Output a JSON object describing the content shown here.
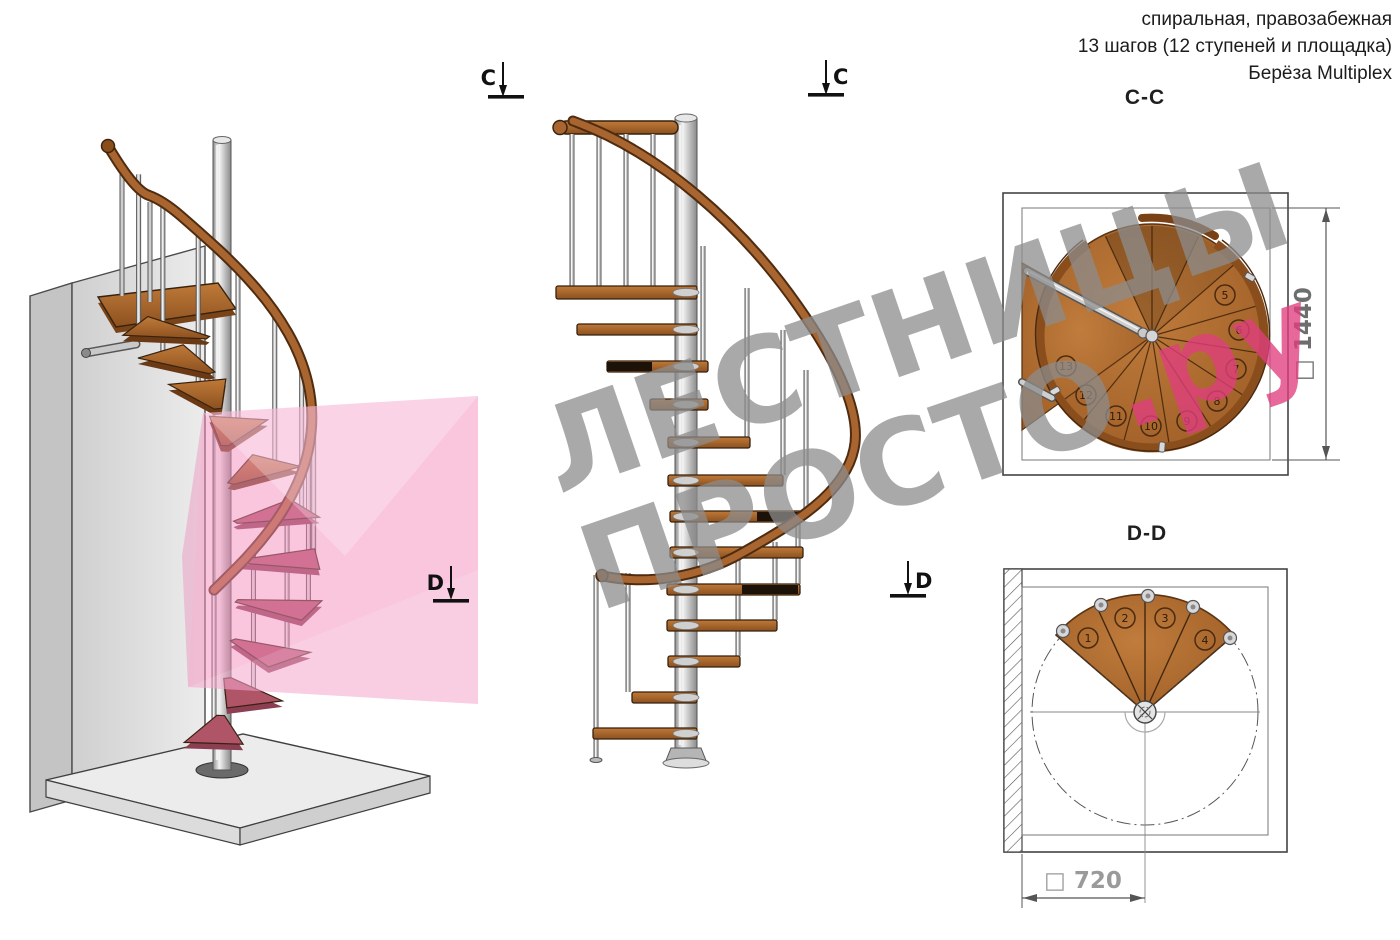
{
  "header": {
    "line1": "спиральная, правозабежная",
    "line2": "13 шагов (12 ступеней и площадка)",
    "line3": "Берёза Multiplex"
  },
  "watermark": {
    "line1": "ЛЕСТНИЦЫ",
    "line2_gray": "ПРОСТО",
    "line2_pink": ".ру"
  },
  "section_markers": {
    "c_left": "C",
    "c_right": "C",
    "d_left": "D",
    "d_right": "D"
  },
  "cc_plan": {
    "title": "C-C",
    "dimension_label": "□ 1440",
    "step_numbers": [
      "5",
      "6",
      "7",
      "8",
      "9",
      "10",
      "11",
      "12",
      "13"
    ]
  },
  "dd_plan": {
    "title": "D-D",
    "dimension_label": "□ 720",
    "step_numbers": [
      "1",
      "2",
      "3",
      "4"
    ]
  },
  "colors": {
    "wood": "#a9652f",
    "wood_dark": "#5d3313",
    "metal": "#c9c9c9",
    "pink_plane": "#f38cba",
    "wall": "#e2e2e2"
  }
}
